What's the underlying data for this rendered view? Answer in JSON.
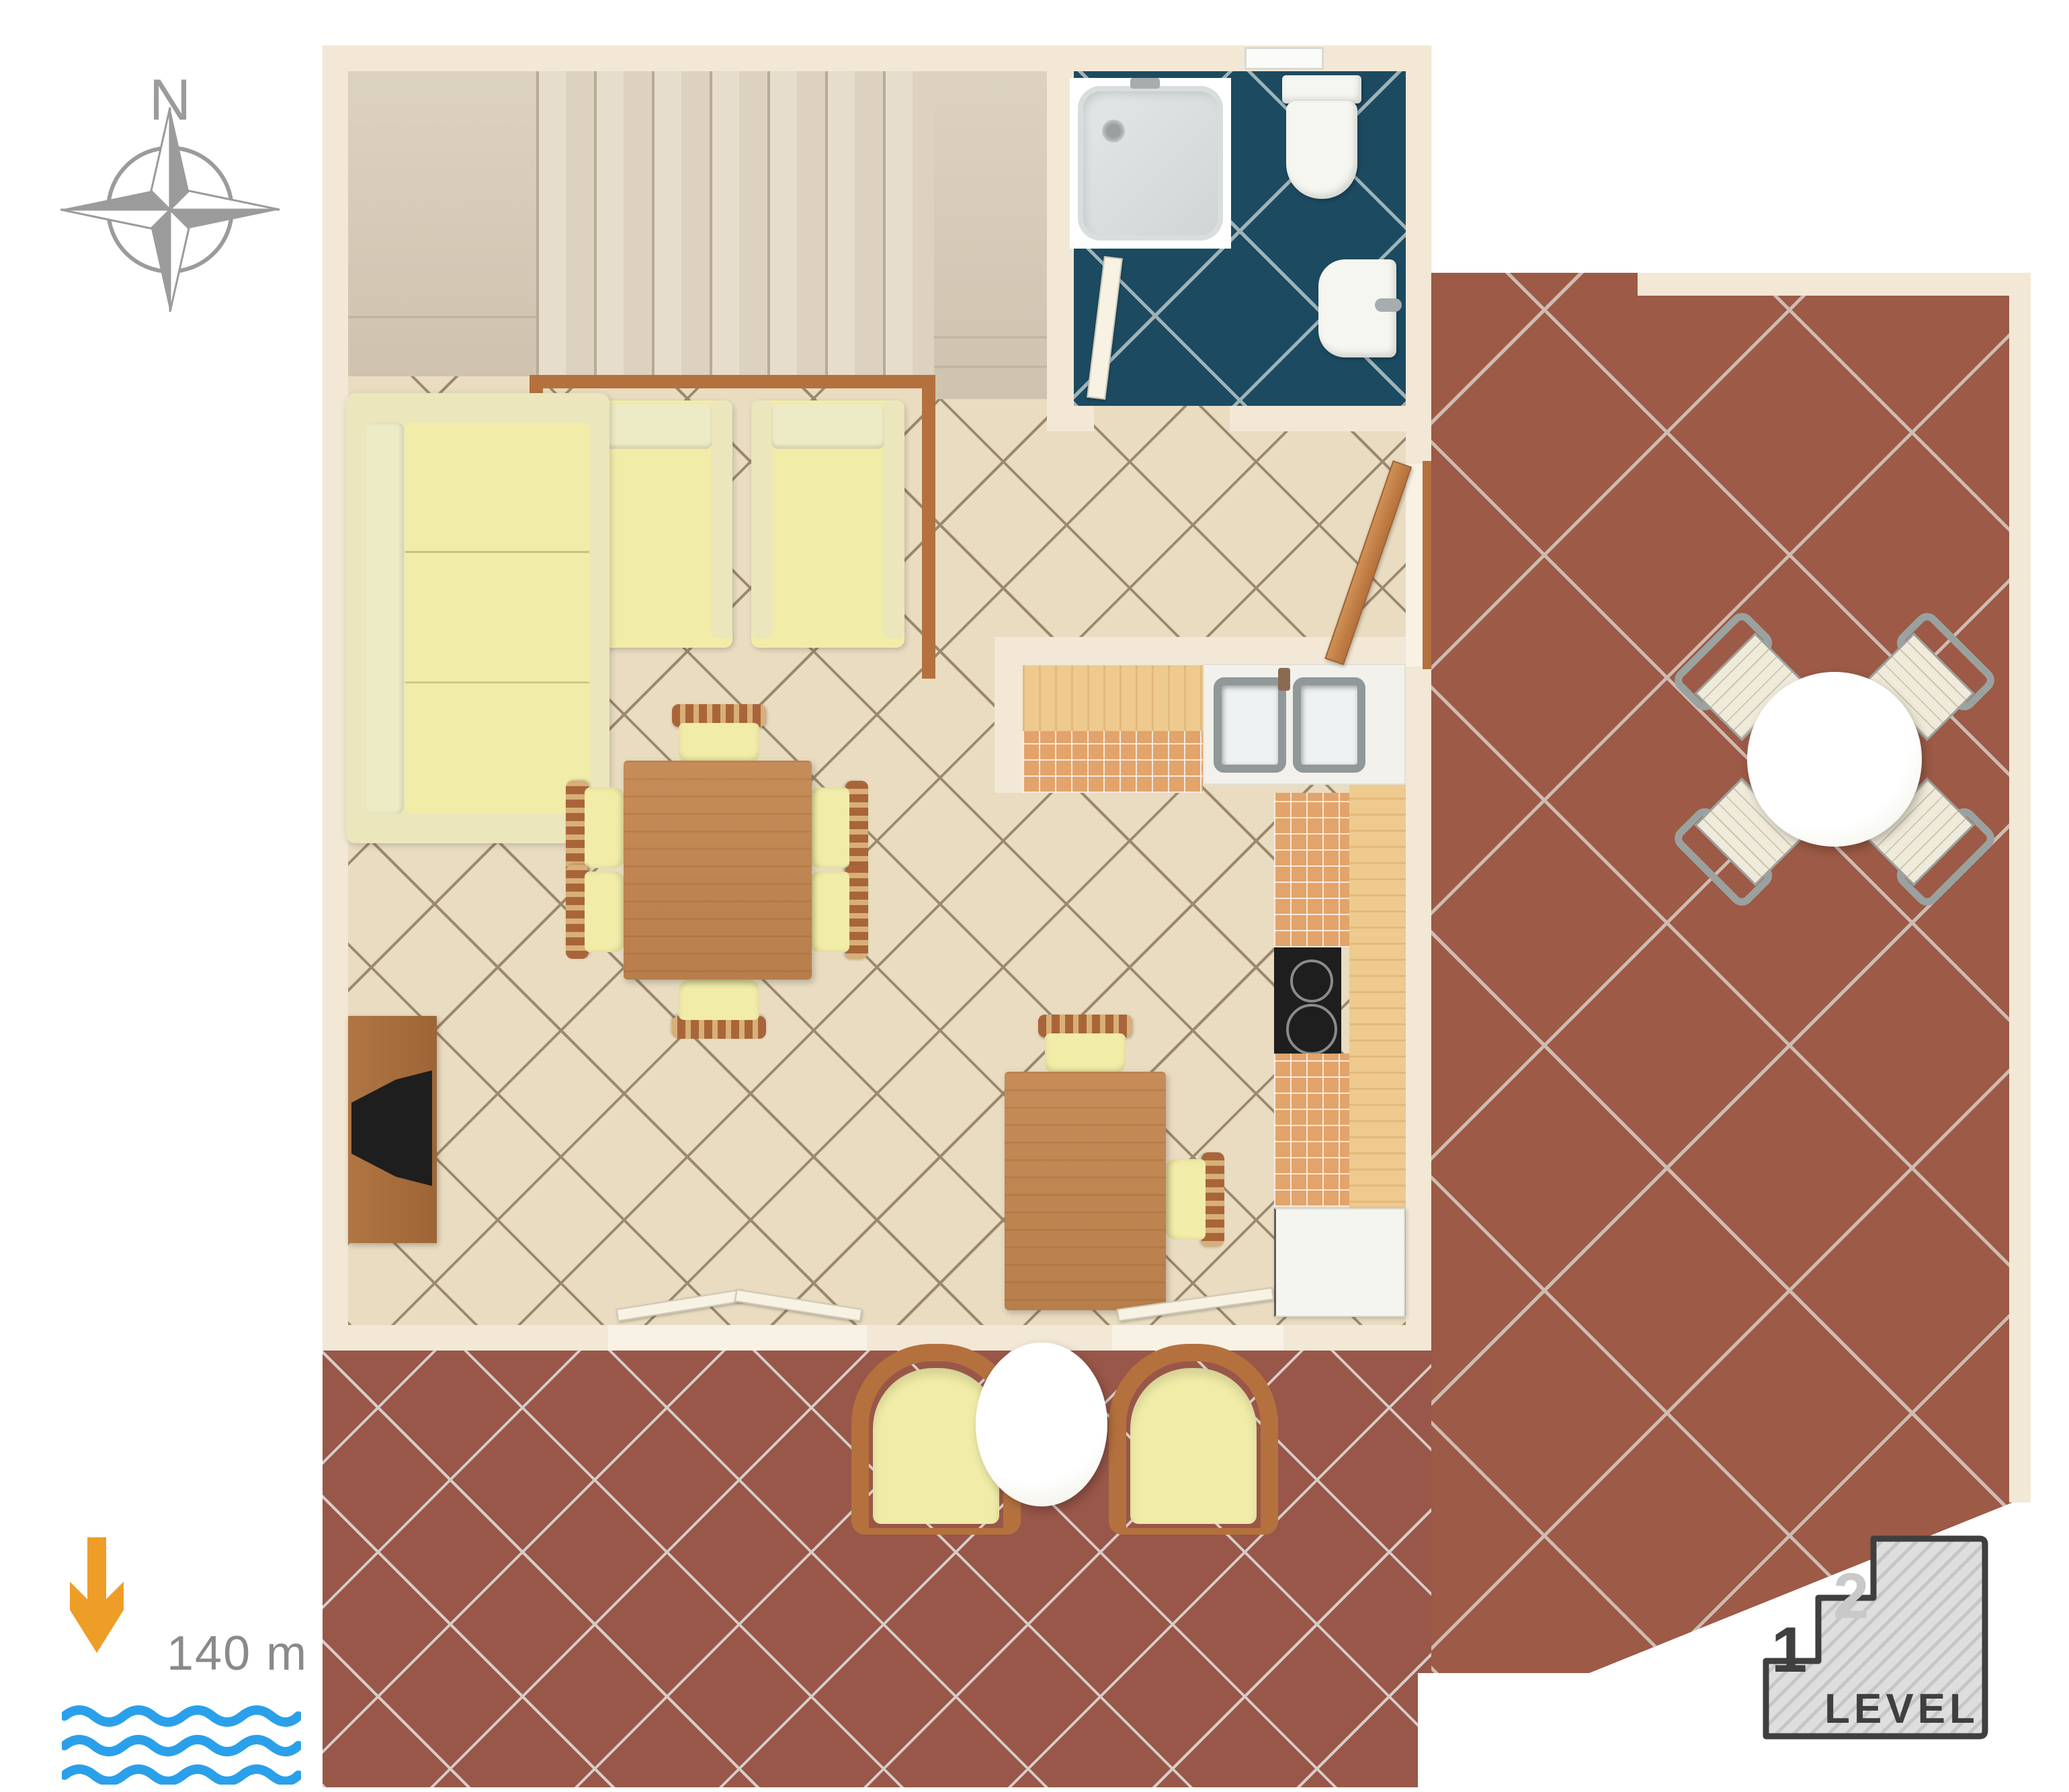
{
  "compass": {
    "label": "N",
    "icon": "compass-rose-icon"
  },
  "sea_indicator": {
    "distance_label": "140 m",
    "icons": [
      "down-arrow-icon",
      "sea-waves-icon"
    ]
  },
  "level_indicator": {
    "label": "LEVEL",
    "level_1": "1",
    "level_2": "2",
    "icon": "stairs-level-icon"
  },
  "palette": {
    "wall": "#f2e8d5",
    "wall_light": "#f8f2e5",
    "floor": "#e9dcc1",
    "floor_line": "#9b8a6d",
    "stairs": "#ddd2c0",
    "stairs_light": "#e7ddcd",
    "stairs_dark": "#cfc3af",
    "stairs_edge": "#b8ab95",
    "bath": "#1c4b61",
    "bath_line": "#9fb3b8",
    "terrace": "#9d5a46",
    "terrace_line": "#cebcb2",
    "terrace2": "#985749",
    "terrace2_line": "#d8ccc6",
    "wood": "#c08552",
    "wood_dark": "#a9653a",
    "wood_slat": "#d8af77",
    "wood_frame": "#b5713d",
    "counter": "#eeca8e",
    "tile_orange": "#e2a46b",
    "cream": "#f1eda8",
    "cream_dark": "#ebe6bb",
    "cream_back": "#edeac6",
    "metal": "#9aa2a0",
    "metal_dark": "#90989a",
    "patio_seat": "#efead9",
    "tv": "#1e1e1e",
    "leaf": "#f7f2e3",
    "leaf_edge": "#cfc8b4",
    "compass_gray": "#9b9b9b",
    "arrow": "#ee9d27",
    "wave": "#2aa0ea",
    "textgray": "#8a8a8a",
    "lvl_dark": "#3f3f3f",
    "lvl_light": "#c9c9c9",
    "lvl_fill": "#dedede",
    "lvl_hatch": "#c6c6c6"
  }
}
